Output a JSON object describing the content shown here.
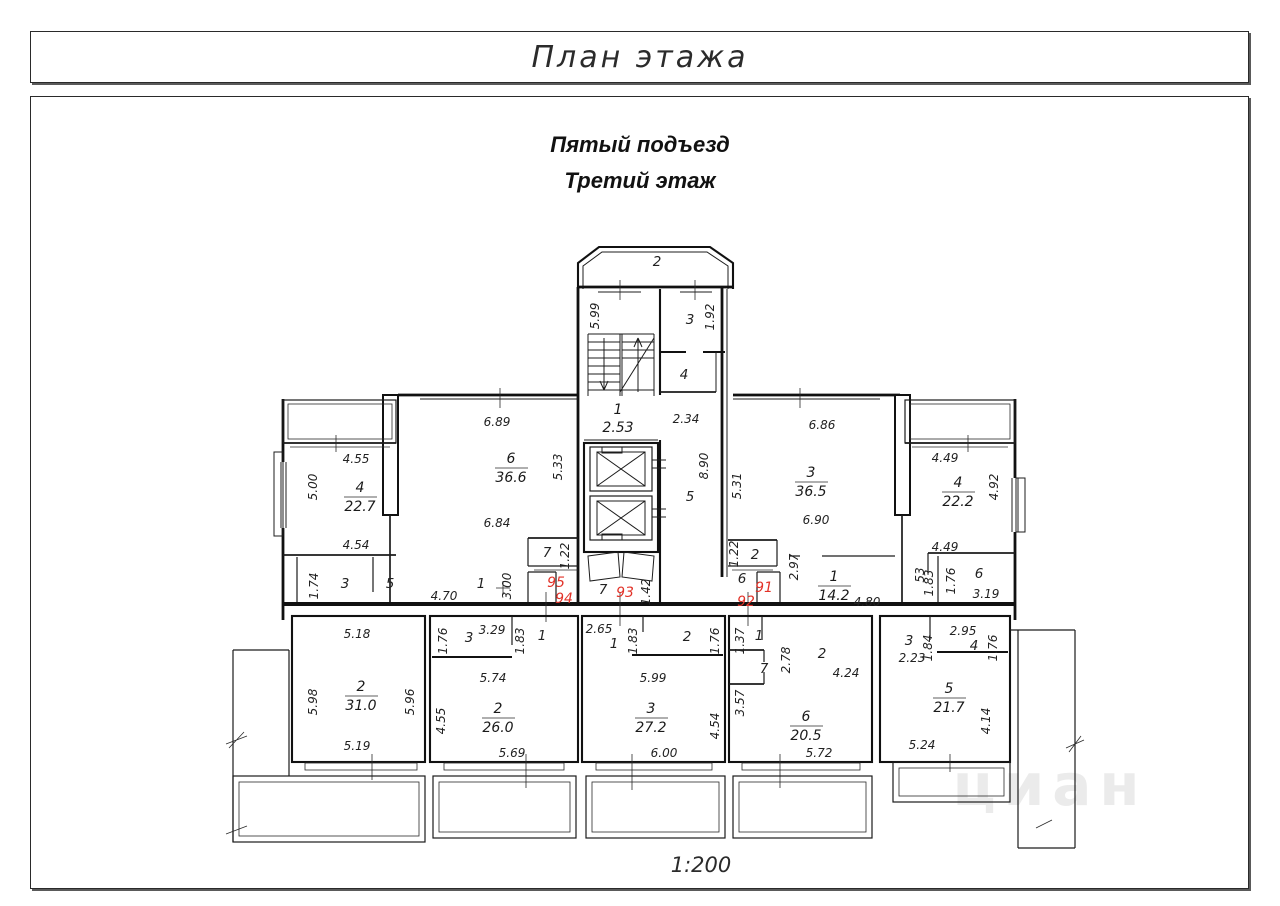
{
  "page": {
    "title": "План этажа",
    "subtitle1": "Пятый подъезд",
    "subtitle2": "Третий этаж",
    "scale": "1:200",
    "watermark": "циан"
  },
  "colors": {
    "line": "#1c1c1c",
    "apartment_number": "#e23228",
    "watermark": "#ebebeb"
  },
  "apartments": {
    "a91": "91",
    "a92": "92",
    "a93": "93",
    "a94": "94",
    "a95": "95"
  },
  "nums": {
    "n1": "1",
    "n2": "2",
    "n3": "3",
    "n4": "4",
    "n5": "5",
    "n6": "6",
    "n7": "7"
  },
  "rooms": {
    "r36_6": {
      "num": "6",
      "area": "36.6"
    },
    "r22_7": {
      "num": "4",
      "area": "22.7"
    },
    "r36_5": {
      "num": "3",
      "area": "36.5"
    },
    "r22_2": {
      "num": "4",
      "area": "22.2"
    },
    "r14_2": {
      "num": "1",
      "area": "14.2"
    },
    "r31_0": {
      "num": "2",
      "area": "31.0"
    },
    "r26_0": {
      "num": "2",
      "area": "26.0"
    },
    "r27_2": {
      "num": "3",
      "area": "27.2"
    },
    "r20_5": {
      "num": "6",
      "area": "20.5"
    },
    "r21_7": {
      "num": "5",
      "area": "21.7"
    },
    "stair": {
      "num": "1",
      "dim": "2.53"
    }
  },
  "dims": {
    "v5_99": "5.99",
    "v1_92": "1.92",
    "h2_34": "2.34",
    "v8_90": "8.90",
    "v5_31": "5.31",
    "v5_33": "5.33",
    "h6_89": "6.89",
    "h6_84": "6.84",
    "h6_86": "6.86",
    "h6_90": "6.90",
    "h4_55": "4.55",
    "v5_00": "5.00",
    "h4_54": "4.54",
    "v1_74": "1.74",
    "h4_70": "4.70",
    "v3_00": "3.00",
    "v1_22": "1.22",
    "v1_42": "1.42",
    "v2_97": "2.97",
    "h4_80": "4.80",
    "h4_49": "4.49",
    "v4_92": "4.92",
    "v0_53": "53",
    "v1_83": "1.83",
    "v1_76": "1.76",
    "h3_19": "3.19",
    "h5_18": "5.18",
    "v5_98": "5.98",
    "v5_96": "5.96",
    "h5_19": "5.19",
    "h3_29": "3.29",
    "h5_74": "5.74",
    "v4_55": "4.55",
    "h5_69": "5.69",
    "h2_65": "2.65",
    "h5_99": "5.99",
    "h6_00": "6.00",
    "v4_54": "4.54",
    "v1_37": "1.37",
    "v2_78": "2.78",
    "h4_24": "4.24",
    "v3_57": "3.57",
    "h5_72": "5.72",
    "h2_23": "2.23",
    "v1_84": "1.84",
    "h2_95": "2.95",
    "v4_14": "4.14",
    "h5_24": "5.24"
  }
}
